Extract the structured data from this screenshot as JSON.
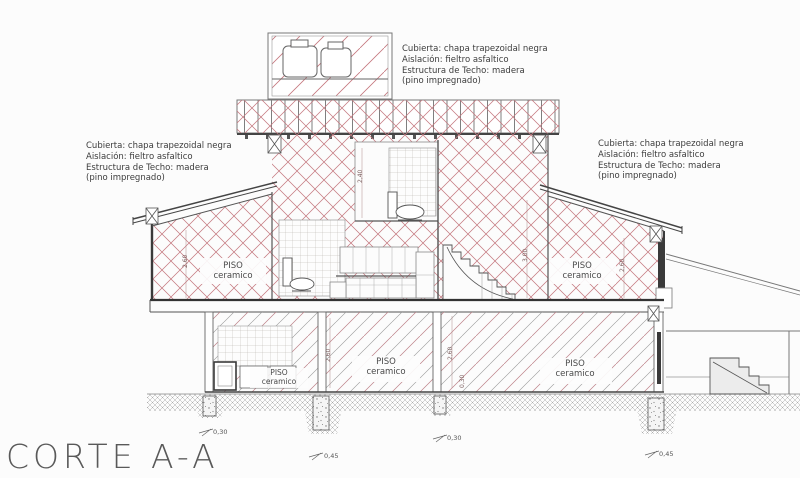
{
  "title": {
    "text": "CORTE A-A"
  },
  "construction_note": {
    "line1": "Cubierta:  chapa trapezoidal negra",
    "line2": "Aislación:  fieltro asfaltico",
    "line3": "Estructura de Techo:  madera",
    "line4": "(pino impregnado)"
  },
  "floor_label": {
    "line1": "PISO",
    "line2": "ceramico"
  },
  "dimensions": {
    "height_260": "2,60",
    "height_240": "2,40",
    "height_300": "3,00",
    "slab_030": "0,30",
    "footing_030": "0,30",
    "footing_045": "0,45"
  },
  "colors": {
    "hatch_red": "#c4777e",
    "line_gray": "#666666",
    "wall_dark": "#3a3a3a",
    "ground_gray": "#9f9f9f",
    "paper": "#fcfcfc"
  }
}
